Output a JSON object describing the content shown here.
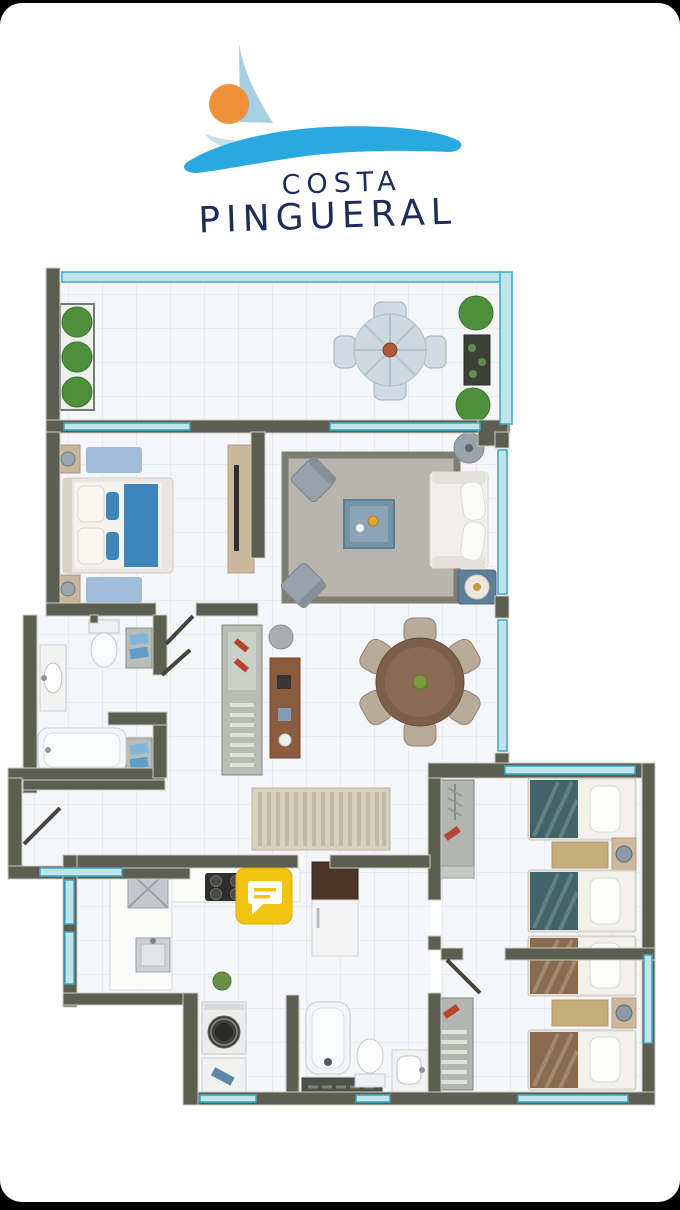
{
  "app": {
    "background_color": "#000000",
    "card_color": "#ffffff"
  },
  "logo": {
    "line1": "COSTA",
    "line2": "PINGUERAL",
    "colors": {
      "text": "#1e2c5c",
      "wave": "#2aa9e0",
      "sail": "#a7d0e2",
      "sun": "#f0923a",
      "hull": "#c6e0ea"
    }
  },
  "floorplan": {
    "colors": {
      "wall": "#5c5e50",
      "wall_trim": "#caccc6",
      "floor": "#f5f6fa",
      "tile_line": "#e3e6ed",
      "glass": "#bfe4ee",
      "glass_frame": "#3aa9c4",
      "accent_blue": "#3e87bc",
      "light_blue_rug": "#9fbcd8",
      "gray_rug": "#b7b5ad",
      "teal_bedding": "#41636a",
      "brown_bedding": "#8a6b4d",
      "khaki_rug": "#c5ad79",
      "wood_brown": "#7c5f4a",
      "tan_furniture": "#c9b59c",
      "plant_green": "#4e8f3c",
      "fixture_white": "#f4f6f7"
    },
    "marker": {
      "name": "comment-marker",
      "icon": "speech-bubble-icon",
      "color": "#f2c411"
    }
  }
}
